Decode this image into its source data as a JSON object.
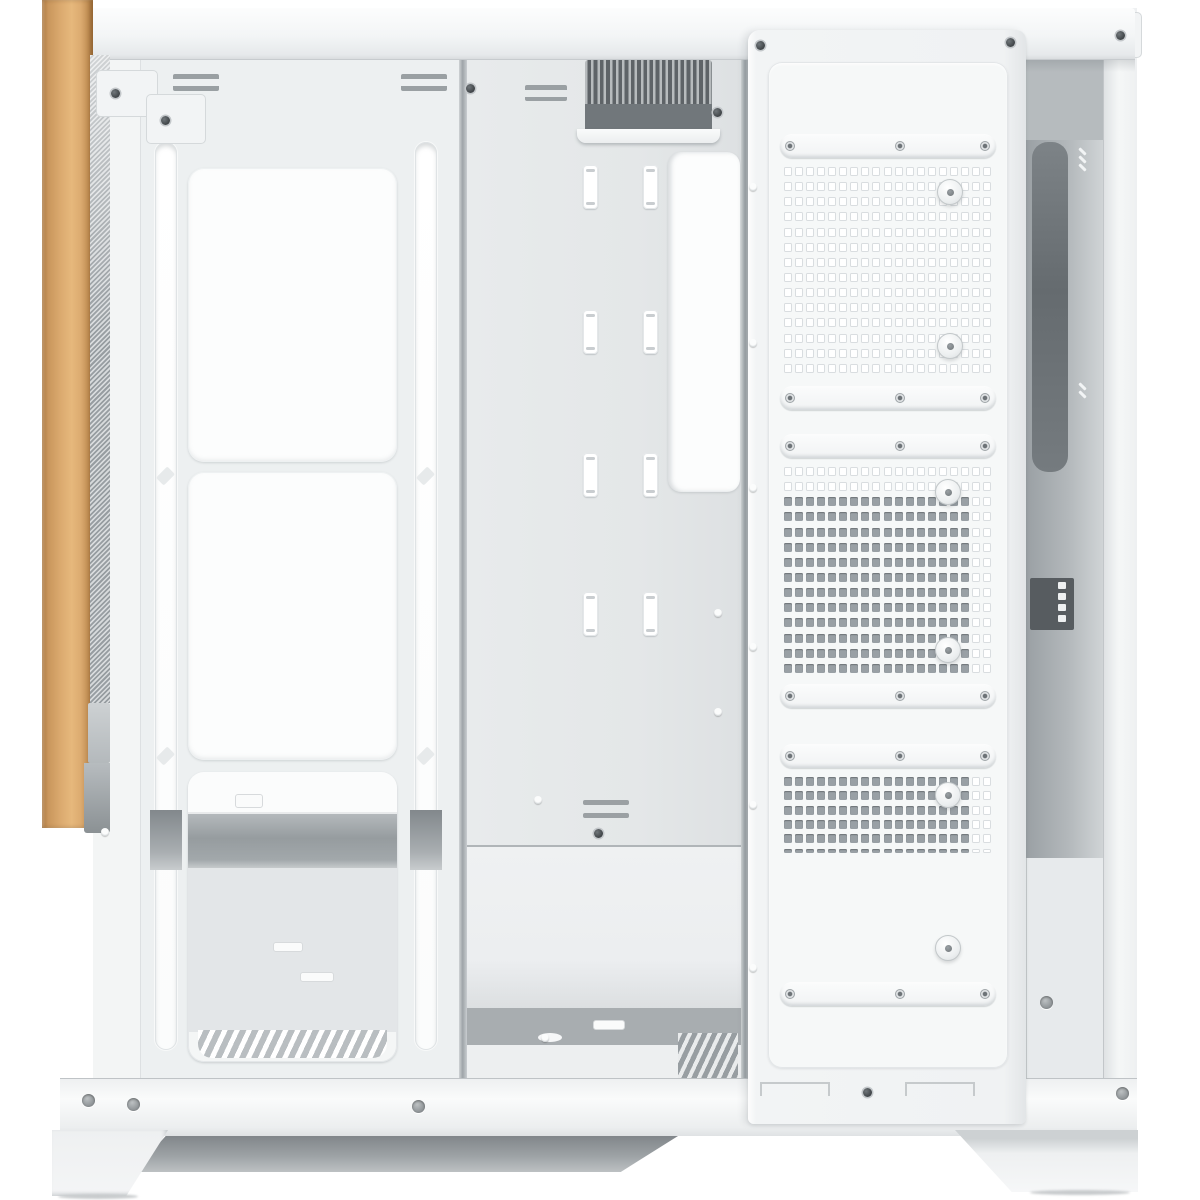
{
  "meta": {
    "subject": "White mid-tower PC case, open-frame side view with front wood accent strip, no visible text",
    "text_content": "none"
  },
  "palette": {
    "bg": "#ffffff",
    "body": "#f0f2f3",
    "panel_white": "#fcfdfd",
    "wood_light": "#dcab70",
    "wood_mid": "#c9965c",
    "wood_dark": "#a9743b",
    "mesh_light": "#d8dbdd",
    "mesh_dark": "#979da1",
    "vent_dark": "#5e6367",
    "vent_slat": "#b7bbbd",
    "vent_panel": "#71777b",
    "interior_shelf": "#969c9f",
    "hole_dark": "#99a0a5",
    "hole_outline": "#d9dde0"
  },
  "case": {
    "front_window_panels": 2,
    "cable_slot_columns": [
      583,
      643
    ],
    "cable_slot_rows": [
      165,
      310,
      453,
      592
    ],
    "pill_strips": [
      {
        "y": 134
      },
      {
        "y": 386
      },
      {
        "y": 434
      },
      {
        "y": 684
      },
      {
        "y": 744
      },
      {
        "y": 982
      }
    ],
    "back_sections": [
      {
        "name": "fan-mount-grid-top",
        "x": 783,
        "y": 166,
        "w": 210,
        "h": 212,
        "rows": 14,
        "cols": 19,
        "dark_from_row": 99,
        "light_from_col": 99,
        "half_last_row": false
      },
      {
        "name": "fan-mount-grid-middle",
        "x": 783,
        "y": 466,
        "w": 210,
        "h": 212,
        "rows": 14,
        "cols": 19,
        "dark_from_row": 2,
        "light_from_col": 17,
        "half_last_row": false
      },
      {
        "name": "fan-mount-grid-bottom",
        "x": 783,
        "y": 776,
        "w": 210,
        "h": 86,
        "rows": 6,
        "cols": 19,
        "dark_from_row": 0,
        "light_from_col": 17,
        "half_last_row": true
      }
    ],
    "screws": [
      {
        "x": 470,
        "y": 88,
        "t": "dark"
      },
      {
        "x": 1010,
        "y": 42,
        "t": "dark"
      },
      {
        "x": 1120,
        "y": 35,
        "t": "dark"
      },
      {
        "x": 760,
        "y": 45,
        "t": "dark"
      },
      {
        "x": 115,
        "y": 93,
        "t": "dark"
      },
      {
        "x": 165,
        "y": 120,
        "t": "dark"
      },
      {
        "x": 753,
        "y": 187,
        "t": "light"
      },
      {
        "x": 753,
        "y": 343,
        "t": "light"
      },
      {
        "x": 753,
        "y": 488,
        "t": "light"
      },
      {
        "x": 753,
        "y": 647,
        "t": "light"
      },
      {
        "x": 753,
        "y": 805,
        "t": "light"
      },
      {
        "x": 753,
        "y": 968,
        "t": "light"
      },
      {
        "x": 717,
        "y": 112,
        "t": "dark"
      },
      {
        "x": 718,
        "y": 613,
        "t": "light"
      },
      {
        "x": 718,
        "y": 712,
        "t": "light"
      },
      {
        "x": 538,
        "y": 800,
        "t": "light"
      },
      {
        "x": 598,
        "y": 833,
        "t": "dark"
      },
      {
        "x": 545,
        "y": 1038,
        "t": "light"
      },
      {
        "x": 105,
        "y": 832,
        "t": "light"
      },
      {
        "x": 88,
        "y": 1100,
        "t": "hole"
      },
      {
        "x": 133,
        "y": 1104,
        "t": "hole"
      },
      {
        "x": 418,
        "y": 1106,
        "t": "hole"
      },
      {
        "x": 867,
        "y": 1092,
        "t": "dark"
      },
      {
        "x": 1122,
        "y": 1093,
        "t": "hole"
      },
      {
        "x": 1046,
        "y": 1002,
        "t": "hole"
      },
      {
        "x": 790,
        "y": 146,
        "t": "ring"
      },
      {
        "x": 900,
        "y": 146,
        "t": "ring"
      },
      {
        "x": 985,
        "y": 146,
        "t": "ring"
      },
      {
        "x": 790,
        "y": 398,
        "t": "ring"
      },
      {
        "x": 900,
        "y": 398,
        "t": "ring"
      },
      {
        "x": 985,
        "y": 398,
        "t": "ring"
      },
      {
        "x": 790,
        "y": 446,
        "t": "ring"
      },
      {
        "x": 900,
        "y": 446,
        "t": "ring"
      },
      {
        "x": 985,
        "y": 446,
        "t": "ring"
      },
      {
        "x": 790,
        "y": 696,
        "t": "ring"
      },
      {
        "x": 900,
        "y": 696,
        "t": "ring"
      },
      {
        "x": 985,
        "y": 696,
        "t": "ring"
      },
      {
        "x": 790,
        "y": 756,
        "t": "ring"
      },
      {
        "x": 900,
        "y": 756,
        "t": "ring"
      },
      {
        "x": 985,
        "y": 756,
        "t": "ring"
      },
      {
        "x": 790,
        "y": 994,
        "t": "ring"
      },
      {
        "x": 900,
        "y": 994,
        "t": "ring"
      },
      {
        "x": 985,
        "y": 994,
        "t": "ring"
      },
      {
        "x": 950,
        "y": 192,
        "t": "thumb"
      },
      {
        "x": 950,
        "y": 346,
        "t": "thumb"
      },
      {
        "x": 948,
        "y": 492,
        "t": "thumb"
      },
      {
        "x": 948,
        "y": 650,
        "t": "thumb"
      },
      {
        "x": 948,
        "y": 795,
        "t": "thumb"
      },
      {
        "x": 948,
        "y": 948,
        "t": "thumb"
      }
    ]
  }
}
